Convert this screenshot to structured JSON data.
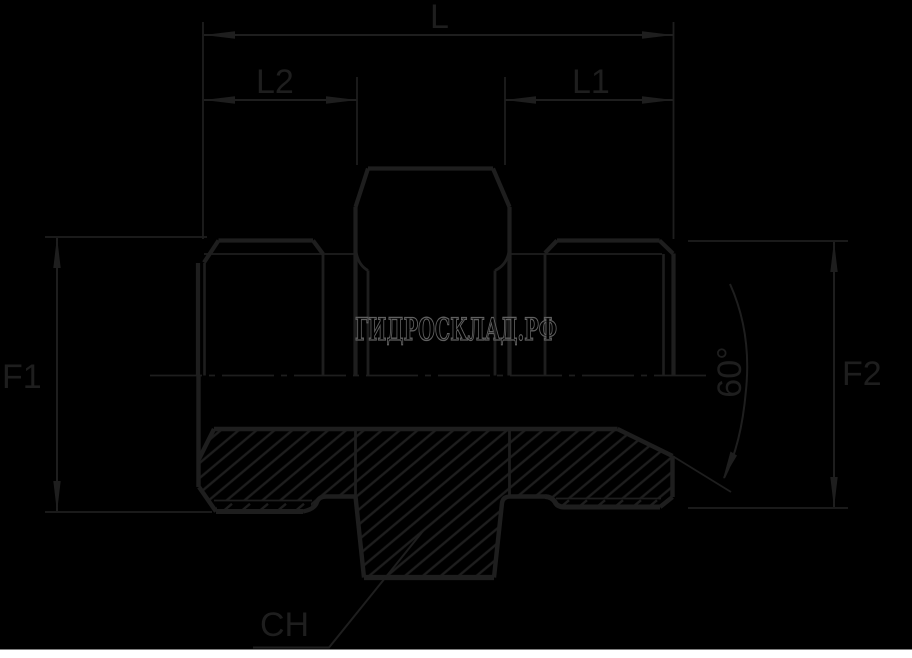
{
  "canvas": {
    "background": "#000000",
    "bottom_strip_color": "#ffffff"
  },
  "drawing": {
    "line_color": "#1e1e1e",
    "description": "Section view of straight male-male hydraulic adapter fitting"
  },
  "watermark": {
    "text": "ГИДРОСКЛАД.РФ",
    "color": "#606060"
  },
  "dimensions": {
    "total_length": "L",
    "right_thread_length": "L1",
    "left_thread_length": "L2",
    "left_size": "F1",
    "right_size": "F2",
    "cone_angle": "60°",
    "hex_size": "CH"
  }
}
